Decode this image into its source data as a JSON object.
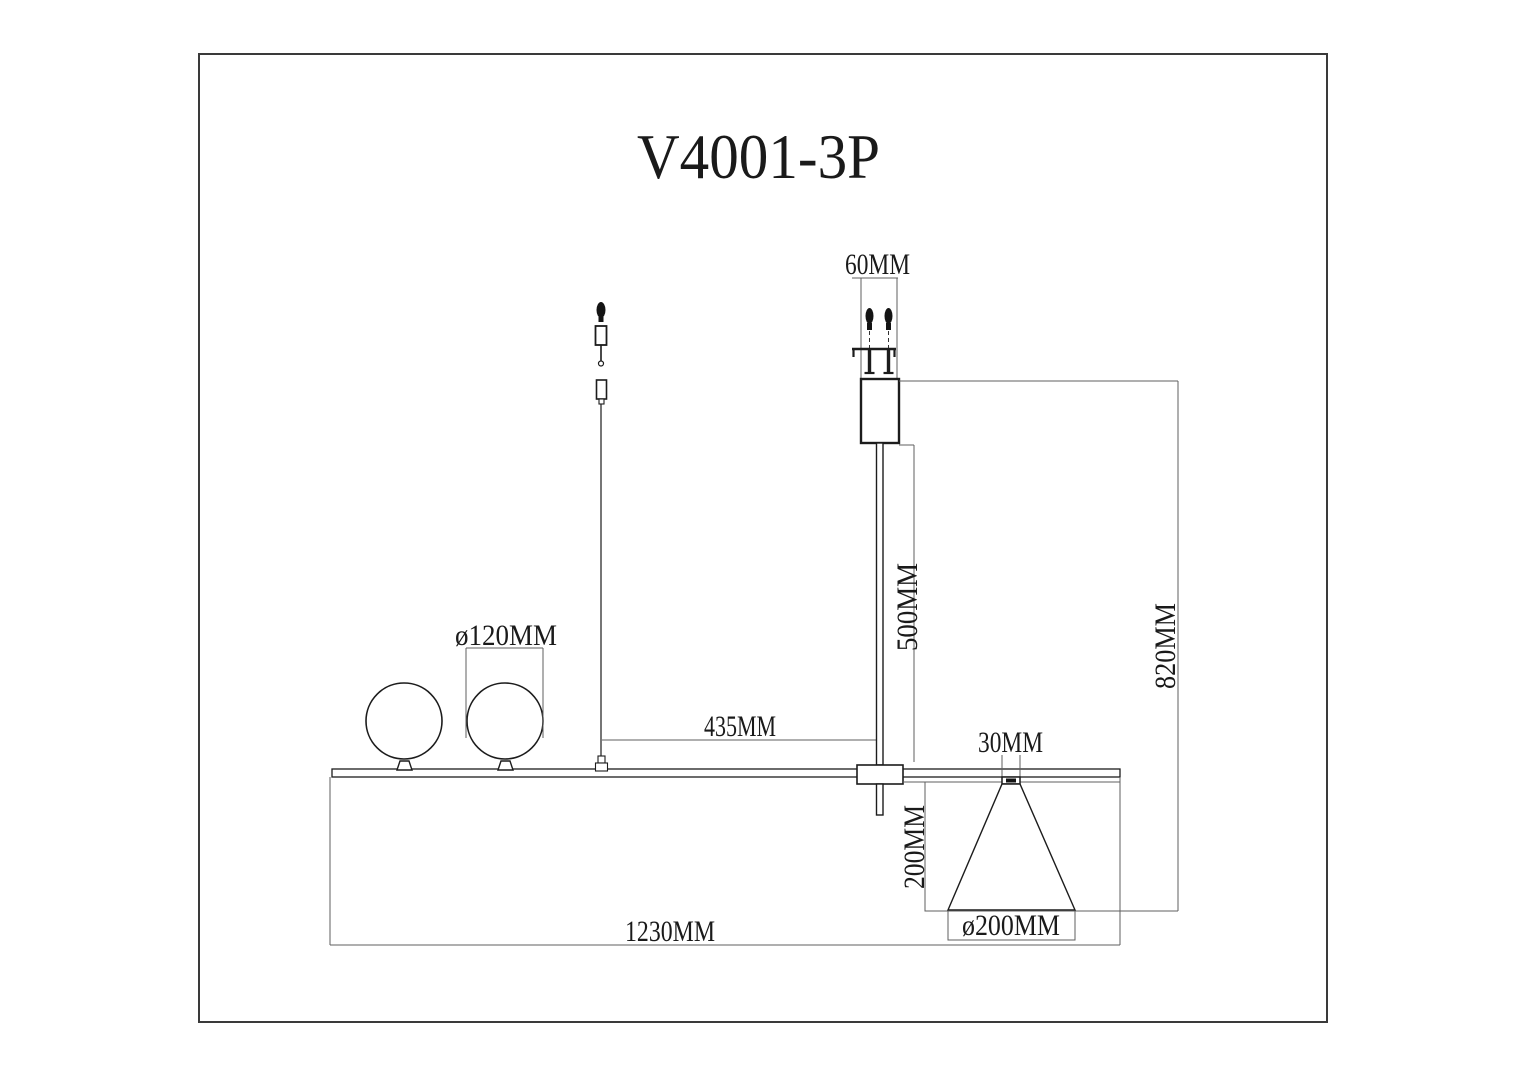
{
  "title": "V4001-3P",
  "labels": {
    "canopy_width": "60MM",
    "globe_diameter": "ø120MM",
    "wire_offset": "435MM",
    "rod_length": "500MM",
    "total_drop": "820MM",
    "neck_width": "30MM",
    "shade_height": "200MM",
    "shade_diameter": "ø200MM",
    "fixture_length": "1230MM"
  },
  "colors": {
    "object_line": "#1c1c1c",
    "dimension_line": "#5f5f5f",
    "frame": "#3a3a3a",
    "background": "#ffffff"
  }
}
